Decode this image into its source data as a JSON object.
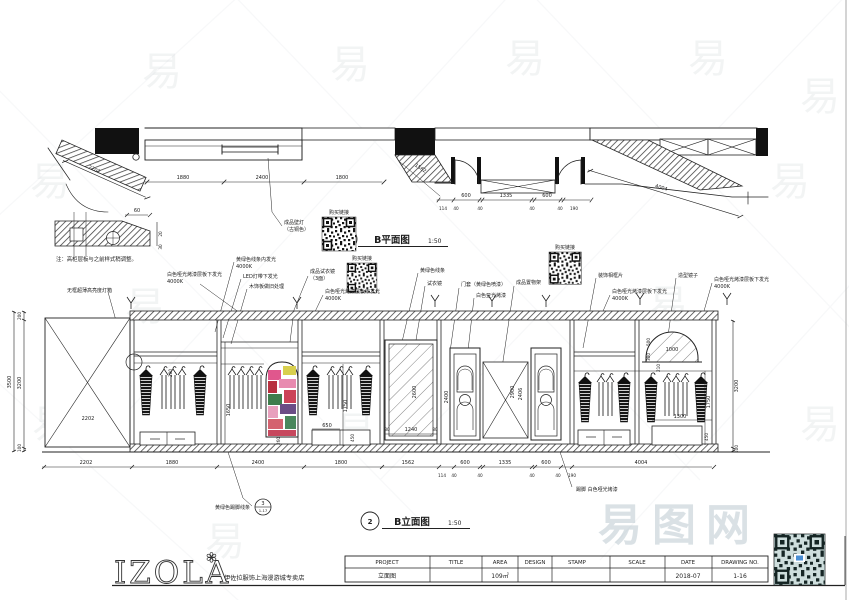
{
  "watermark": {
    "char": "易",
    "site": "易图网"
  },
  "plan": {
    "bubble": "1",
    "title": "B平面图",
    "scale": "1:50"
  },
  "elevation": {
    "bubble": "2",
    "title": "B立面图",
    "scale": "1:50"
  },
  "detail_note": {
    "text": "注：高柜层板与之前样式稍调整。"
  },
  "dims": {
    "d2202": "2202",
    "d1880": "1880",
    "d2400": "2400",
    "d1800": "1800",
    "d1562": "1562",
    "d4004": "4004",
    "d114": "114",
    "d40": "40",
    "d600": "600",
    "d1335": "1335",
    "d190": "190",
    "d60": "60",
    "d30": "30",
    "d20": "20",
    "d3500": "3500",
    "d3200": "3200",
    "d200": "200",
    "d100": "100",
    "d1650": "1650",
    "d260": "260",
    "d650": "650",
    "d450": "450",
    "d1750": "1750",
    "d80": "80",
    "d1240": "1240",
    "d2600": "2600",
    "d2900": "2900",
    "d2406": "2406",
    "d2400b": "2400",
    "d500": "500",
    "d300": "300",
    "d1000": "1000",
    "d210": "210",
    "d1300": "1300"
  },
  "labels": {
    "purchase": "购买链接",
    "wall_lamp1": "成品壁灯",
    "wall_lamp2": "（古铜色）",
    "fitting_product1": "成品试衣镜",
    "fitting_product2": "（3面）",
    "white_glow": "白色哑光烤漆层板下发光",
    "k4000": "4000K",
    "yellow_green_line": "黄绿色线条",
    "fitting_mirror": "试衣镜",
    "door_frame": "门套（黄绿色喷漆）",
    "white_matte": "白色亚光烤漆",
    "shelf_product": "成品置物架",
    "deco_frame": "装饰相框片",
    "shaped_mirror": "造型镜子",
    "frameless_lightbox": "无框超薄高亮度灯箱",
    "yg_line_glow": "黄绿色线条内发光",
    "led_glow": "LED灯带下发光",
    "wood_aged": "木饰板做旧处理",
    "skirting_line": "黄绿色踢脚线条",
    "skirting_bubble_no": "3",
    "skirting_bubble_ref": "1-17",
    "skirting_white": "踢脚 白色哑光烤漆"
  },
  "titleblock": {
    "logo": "IZOLA",
    "flower": "✽",
    "subtitle": "伊佐拉服饰上海漫游城专卖店",
    "cols": [
      "PROJECT",
      "TITLE",
      "AREA",
      "DESIGN",
      "STAMP",
      "SCALE",
      "DATE",
      "DRAWING NO."
    ],
    "vals": [
      "立面图",
      "",
      "109㎡",
      "",
      "",
      "",
      "2018-07",
      "1-16"
    ]
  }
}
